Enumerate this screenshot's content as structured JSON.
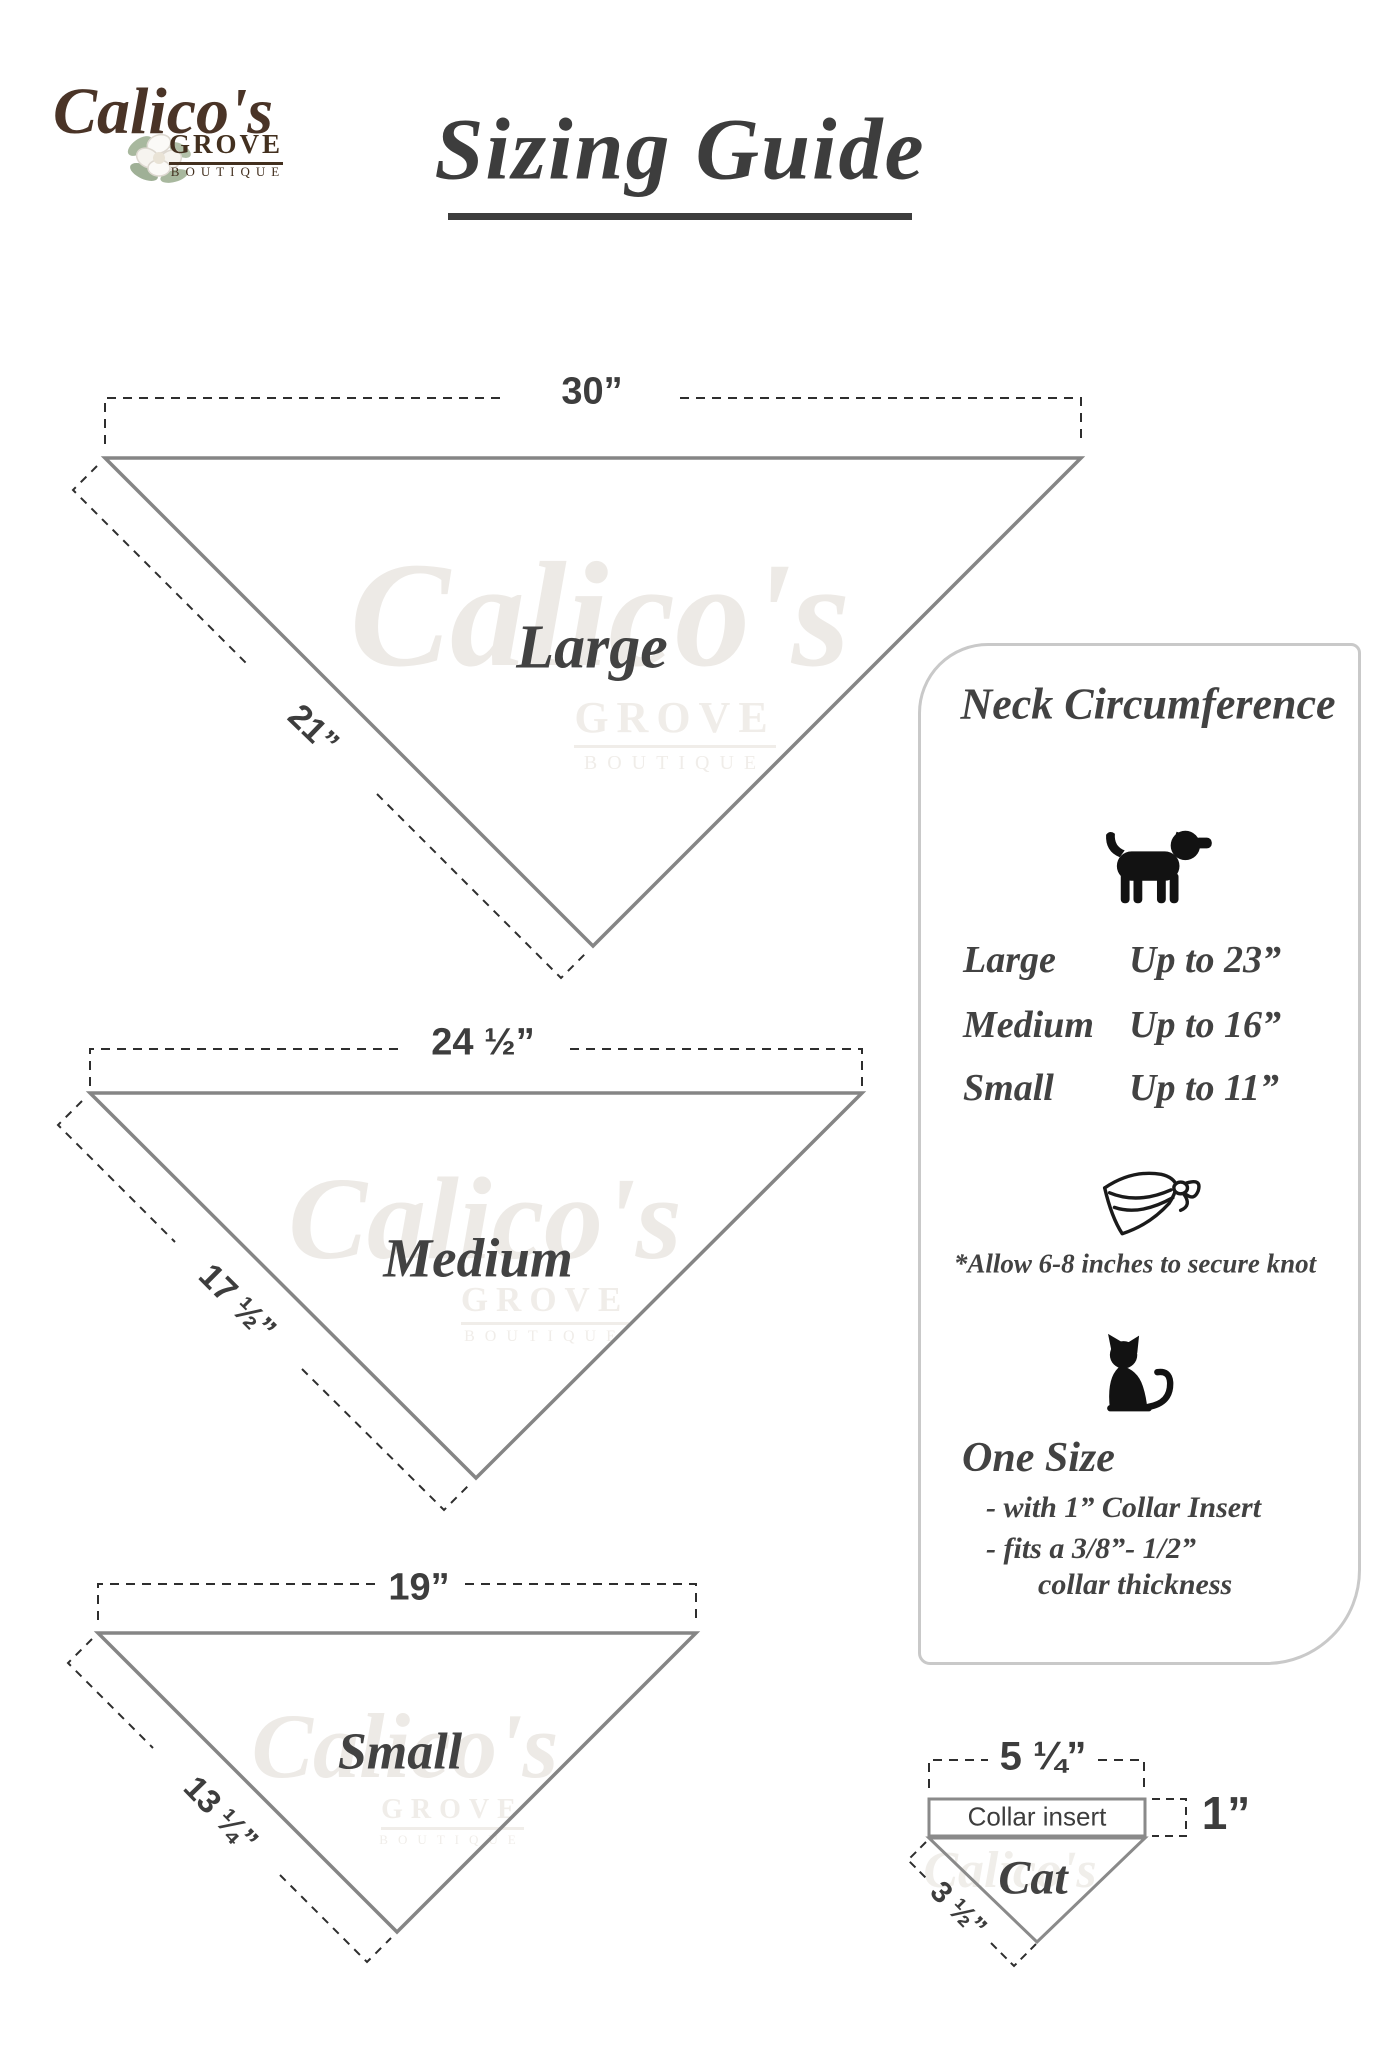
{
  "logo": {
    "name": "Calico's",
    "grove": "GROVE",
    "boutique": "BOUTIQUE"
  },
  "title": "Sizing Guide",
  "bandanas": {
    "large": {
      "label": "Large",
      "top_label": "30”",
      "side_label": "21”"
    },
    "medium": {
      "label": "Medium",
      "top_label": "24 ½”",
      "side_label": "17 ½”"
    },
    "small": {
      "label": "Small",
      "top_label": "19”",
      "side_label": "13 ¼”"
    }
  },
  "panel": {
    "heading": "Neck Circumference",
    "rows": [
      {
        "size": "Large",
        "limit": "Up to 23”"
      },
      {
        "size": "Medium",
        "limit": "Up to 16”"
      },
      {
        "size": "Small",
        "limit": "Up to 11”"
      }
    ],
    "knot_note": "*Allow 6-8 inches to secure knot",
    "one_size": {
      "heading": "One Size",
      "line1": "- with 1” Collar Insert",
      "line2": "- fits a 3/8”- 1/2”",
      "line3": "collar thickness"
    }
  },
  "cat_diagram": {
    "top_label": "5 ¼”",
    "insert_label": "Collar insert",
    "height_label": "1”",
    "label": "Cat",
    "side_label": "3 ½”"
  },
  "watermark": {
    "script": "Calico's",
    "grove": "GROVE",
    "boutique": "BOUTIQUE"
  },
  "icons": {
    "dog": "dog-icon",
    "bandana": "bandana-knot-icon",
    "cat": "cat-icon",
    "flower": "magnolia-flower-icon"
  },
  "colors": {
    "text": "#3d3d3d",
    "triangle_stroke": "#858585",
    "dash": "#2e2e2e",
    "logo_brown": "#4a3427",
    "panel_border": "#c9c9c9",
    "watermark": "#edeae6",
    "leaf_green": "#a8b89e"
  }
}
